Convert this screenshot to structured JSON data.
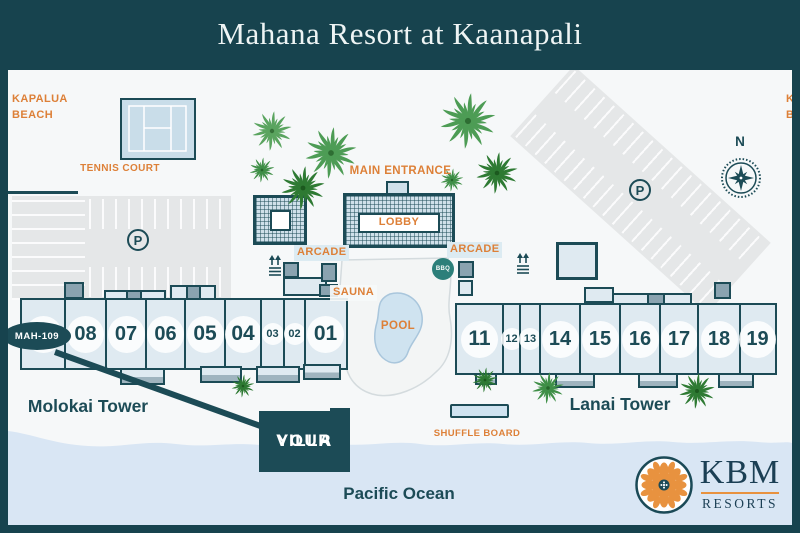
{
  "header": {
    "title": "Mahana Resort at Kaanapali"
  },
  "map": {
    "beach_left": {
      "line1": "KAPALUA",
      "line2": "BEACH"
    },
    "beach_right": {
      "line1": "KAANAPALI",
      "line2": "BEACH"
    },
    "tennis_court": "TENNIS COURT",
    "main_entrance": "MAIN ENTRANCE",
    "lobby": "LOBBY",
    "arcade_left": "ARCADE",
    "arcade_right": "ARCADE",
    "sauna": "SAUNA",
    "bbq": "BBQ",
    "pool": "POOL",
    "shuffle_board": "SHUFFLE BOARD",
    "ocean": "Pacific Ocean",
    "compass_n": "N",
    "parking_symbol": "P"
  },
  "towers": {
    "molokai": {
      "name": "Molokai Tower",
      "units": [
        "08",
        "07",
        "06",
        "05",
        "04",
        "03",
        "02",
        "01"
      ]
    },
    "lanai": {
      "name": "Lanai Tower",
      "units": [
        "11",
        "12",
        "13",
        "14",
        "15",
        "16",
        "17",
        "18",
        "19"
      ]
    }
  },
  "villa": {
    "unit_badge": "MAH-109",
    "callout": {
      "line1": "YOUR",
      "line2": "VILLA"
    }
  },
  "logo": {
    "name": "KBM",
    "subtitle": "RESORTS"
  },
  "colors": {
    "teal": "#1c4b56",
    "orange": "#dd8038",
    "building_fill": "#dfeaf1",
    "ocean_fill": "#d9e6f4",
    "parking_fill": "#e5e7e8",
    "pool_fill": "#cfe3f0",
    "palm_green": "#3a8a42",
    "logo_orange": "#e8923f"
  }
}
